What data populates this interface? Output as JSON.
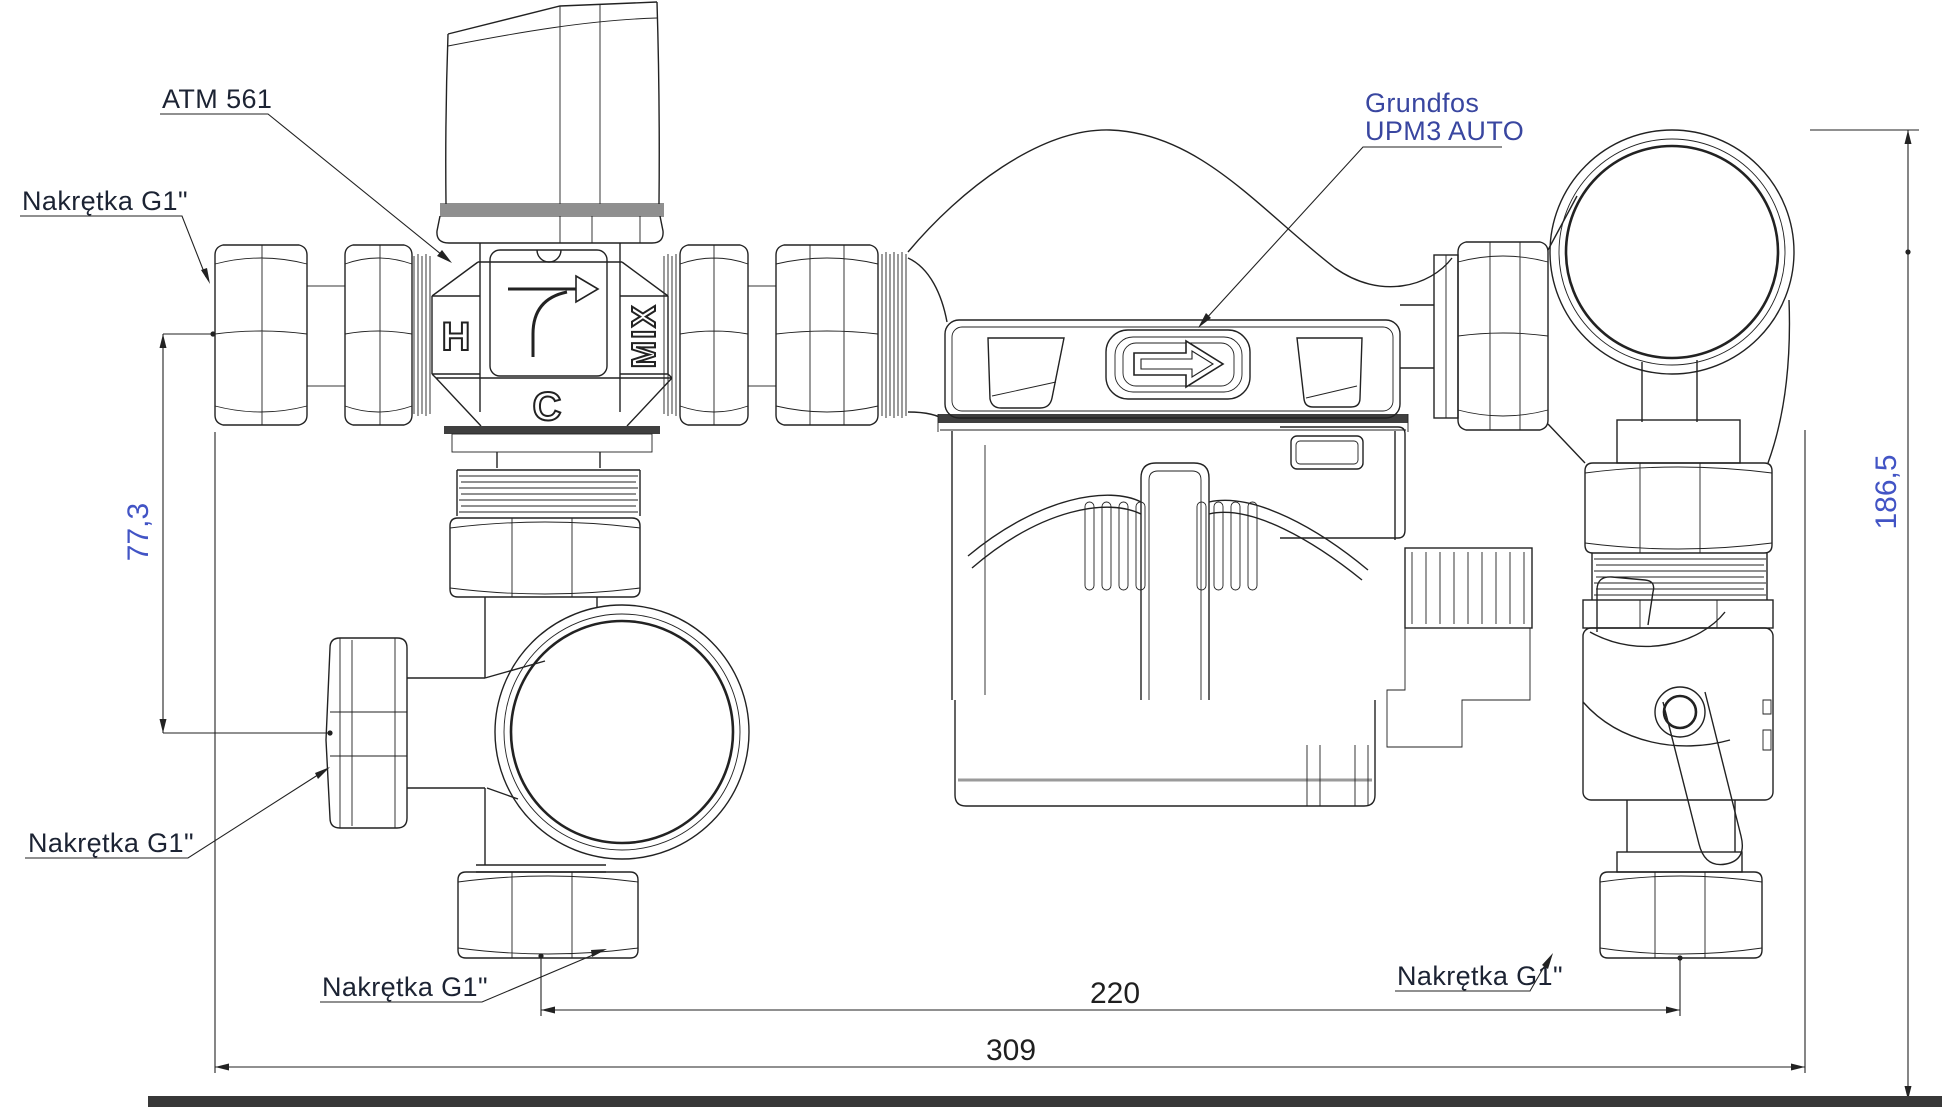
{
  "drawing": {
    "callouts": {
      "valve_model": "ATM 561",
      "pump_brand": "Grundfos",
      "pump_model": "UPM3 AUTO",
      "nut_top_left": "Nakrętka G1\"",
      "nut_mid_left": "Nakrętka G1\"",
      "nut_bottom_center": "Nakrętka G1\"",
      "nut_bottom_right": "Nakrętka G1\""
    },
    "port_labels": {
      "hot": "H",
      "cold": "C",
      "mix": "MIX"
    },
    "dimensions": {
      "left_height_mm": "77,3",
      "total_height_mm": "186,5",
      "pump_group_width_mm": "220",
      "total_width_mm": "309"
    },
    "colors": {
      "line": "#222222",
      "dimension_text_blue": "#4254c5",
      "dimension_text_dark": "#1f1f1f",
      "callout_text": "#1c2333",
      "brand_text": "#3946a0",
      "clamp_band": "#3f3f3f",
      "knob_band": "#8f8f8f",
      "baseplate_bar": "#383838"
    }
  }
}
